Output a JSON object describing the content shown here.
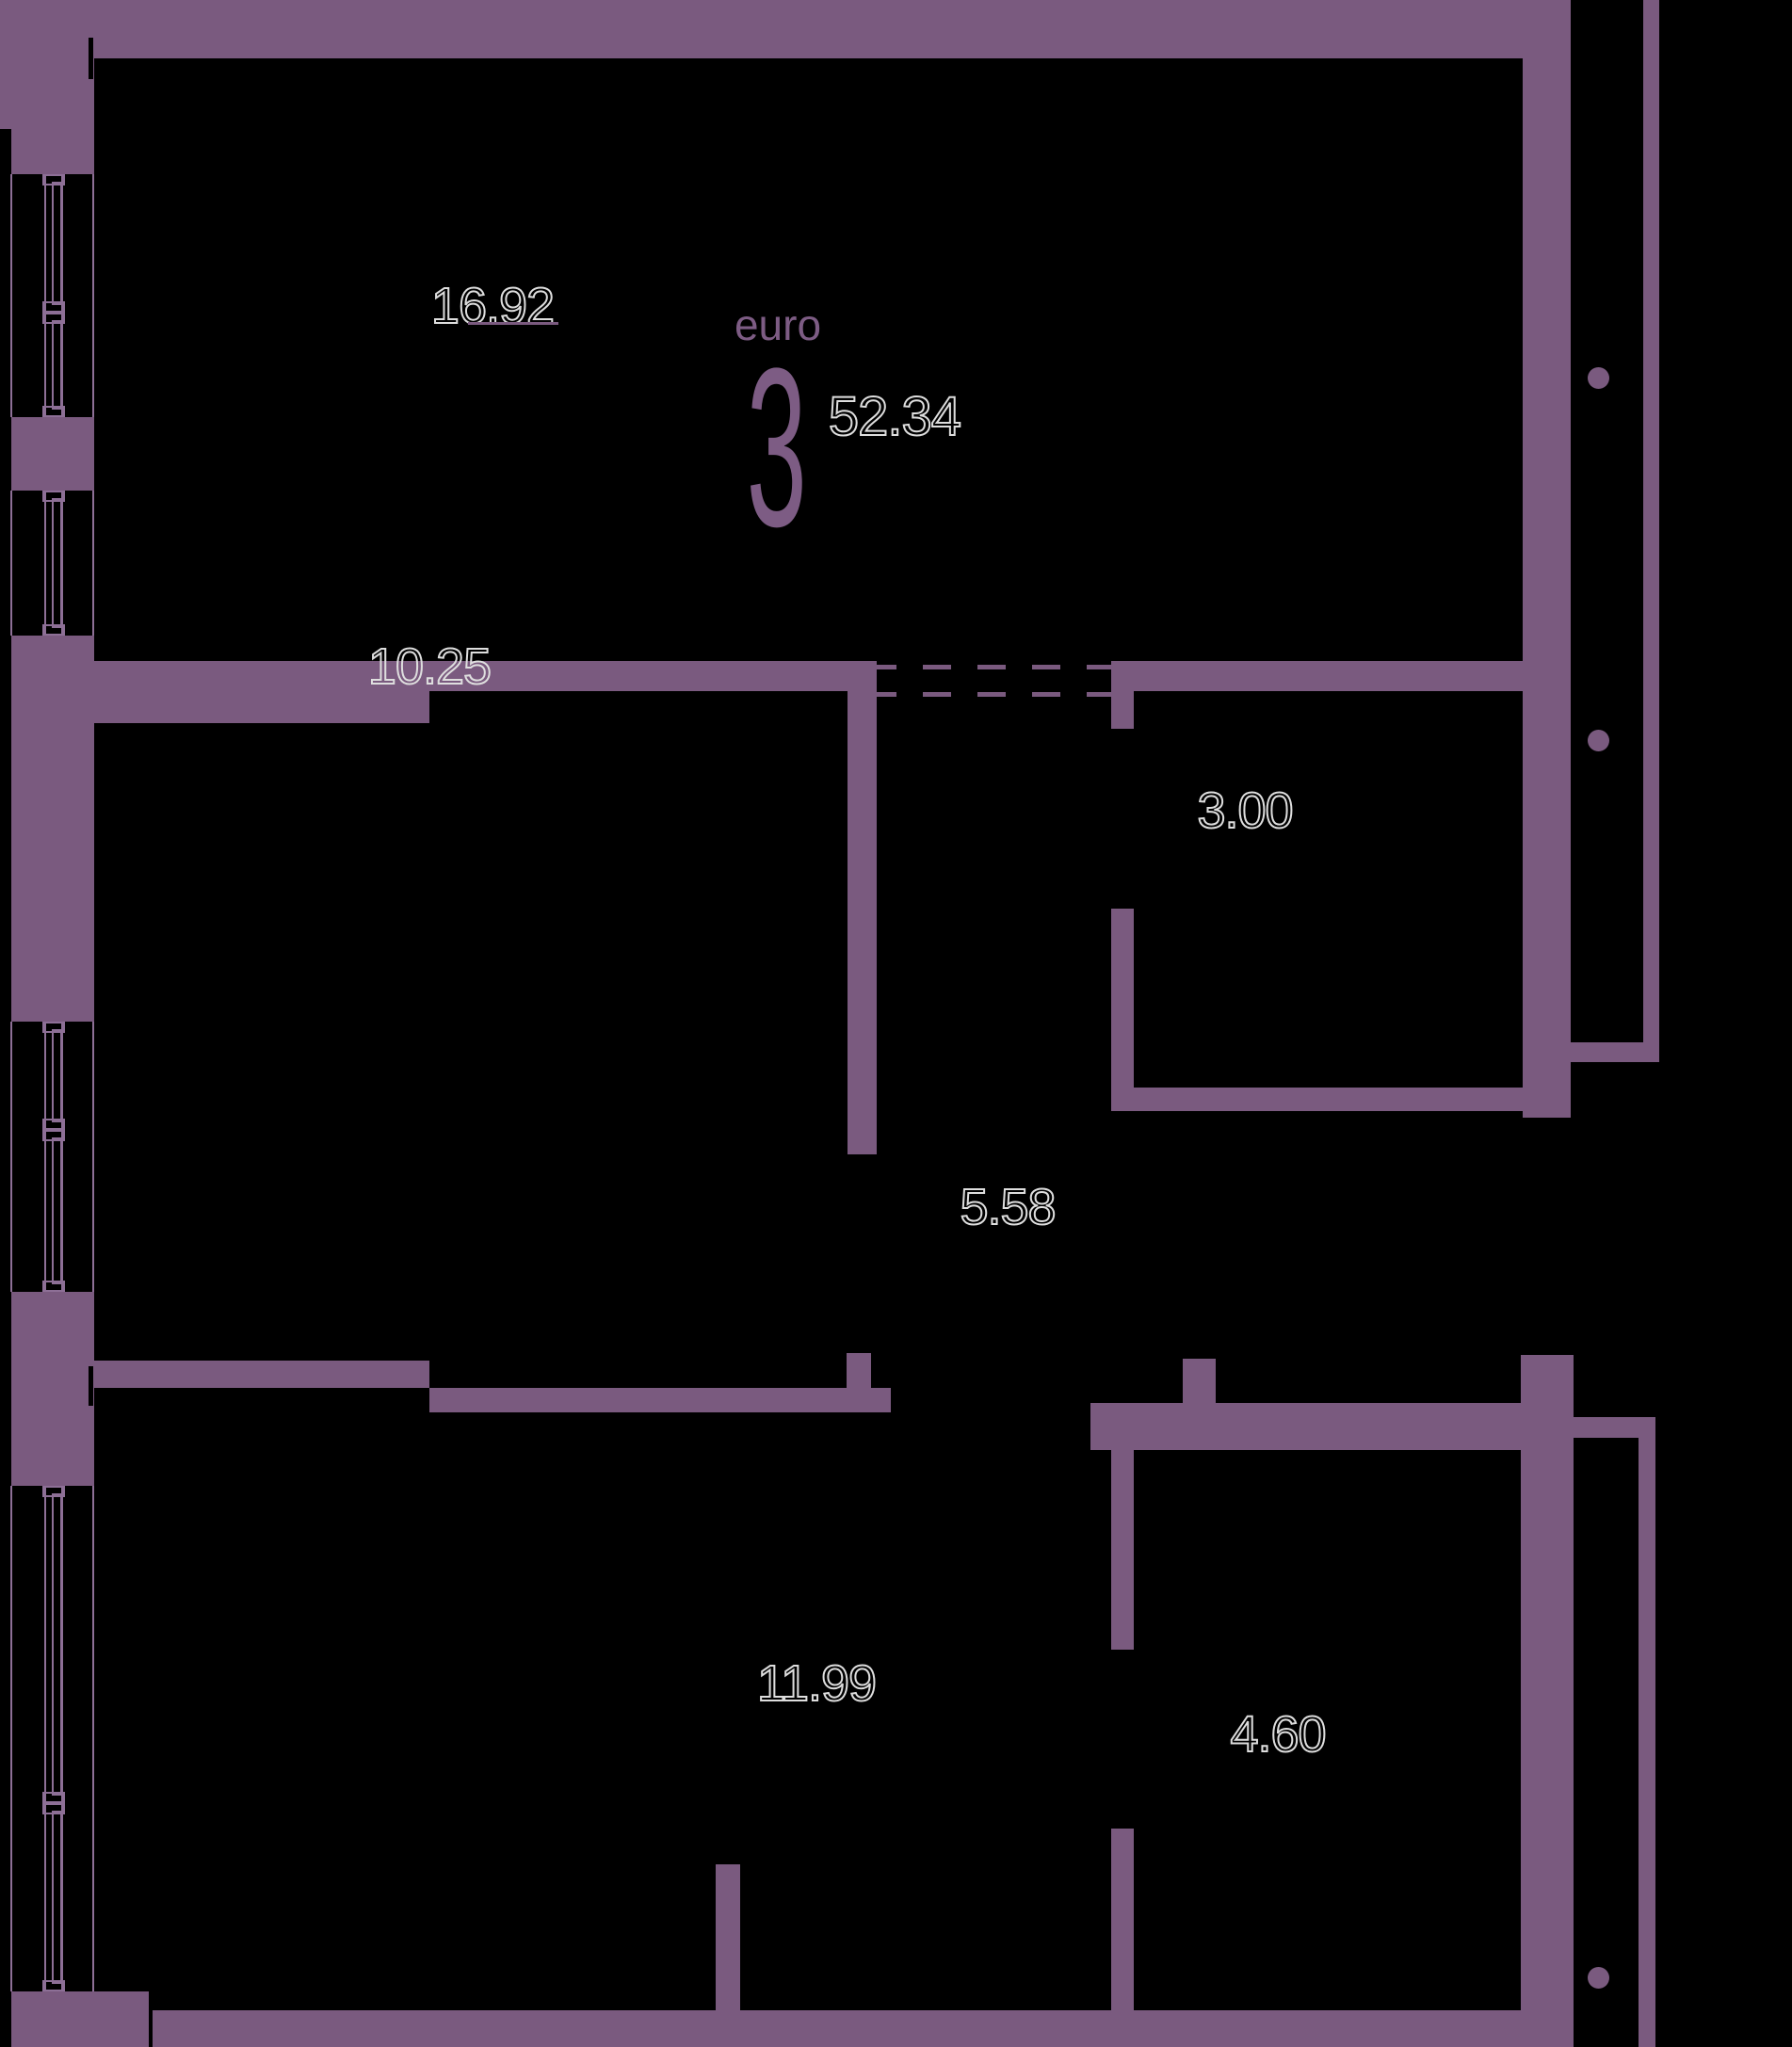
{
  "plan": {
    "logo": {
      "brand": "euro",
      "rooms_digit": "3",
      "total_area": "52.34"
    },
    "rooms": [
      {
        "id": "living-kitchen",
        "area": "16.92"
      },
      {
        "id": "bedroom-1",
        "area": "10.25"
      },
      {
        "id": "bathroom-1",
        "area": "3.00"
      },
      {
        "id": "hallway",
        "area": "5.58"
      },
      {
        "id": "bedroom-2",
        "area": "11.99"
      },
      {
        "id": "bathroom-2",
        "area": "4.60"
      }
    ]
  },
  "colors": {
    "background": "#000000",
    "wall": "#7a5a7f",
    "window_frame": "#8d6f96",
    "logo": "#7d5c84",
    "label_outline": "#dedede"
  }
}
